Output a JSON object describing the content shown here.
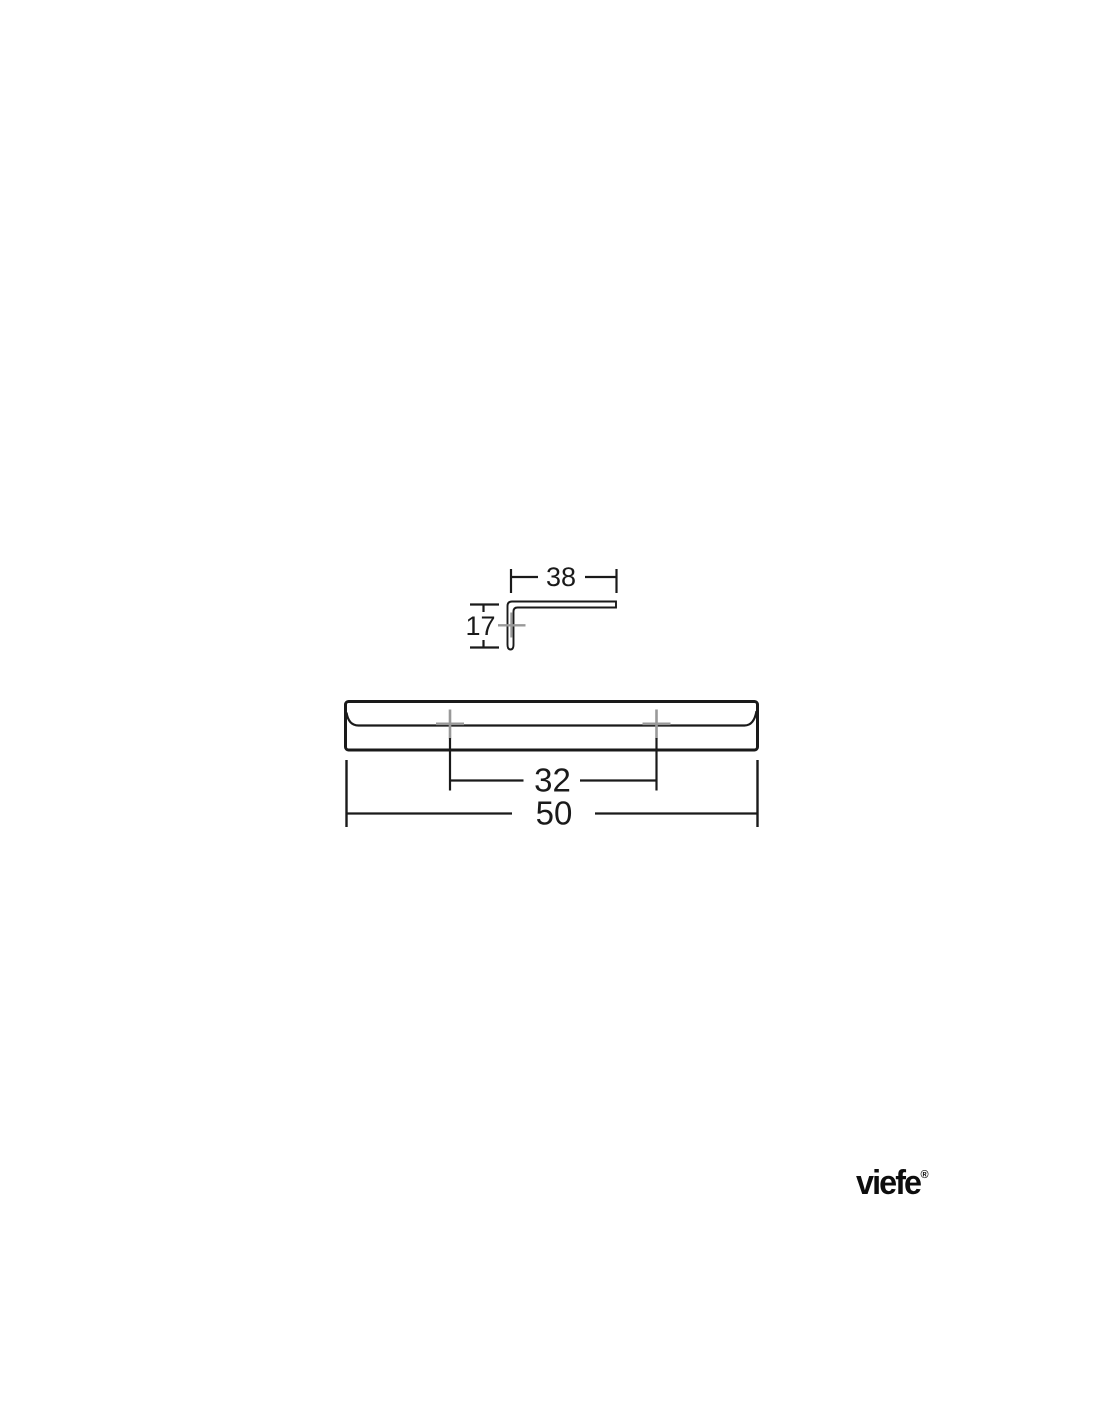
{
  "drawing": {
    "title_hint": "handle technical drawing",
    "profile_view": {
      "flange_width_label": "38",
      "height_label": "17"
    },
    "front_view": {
      "hole_spacing_label": "32",
      "length_label": "50"
    }
  },
  "brand": {
    "logo_text": "viefe",
    "registered_mark": "®"
  },
  "colors": {
    "line": "#1a1a1a",
    "center_mark": "#999999",
    "background": "#ffffff"
  }
}
